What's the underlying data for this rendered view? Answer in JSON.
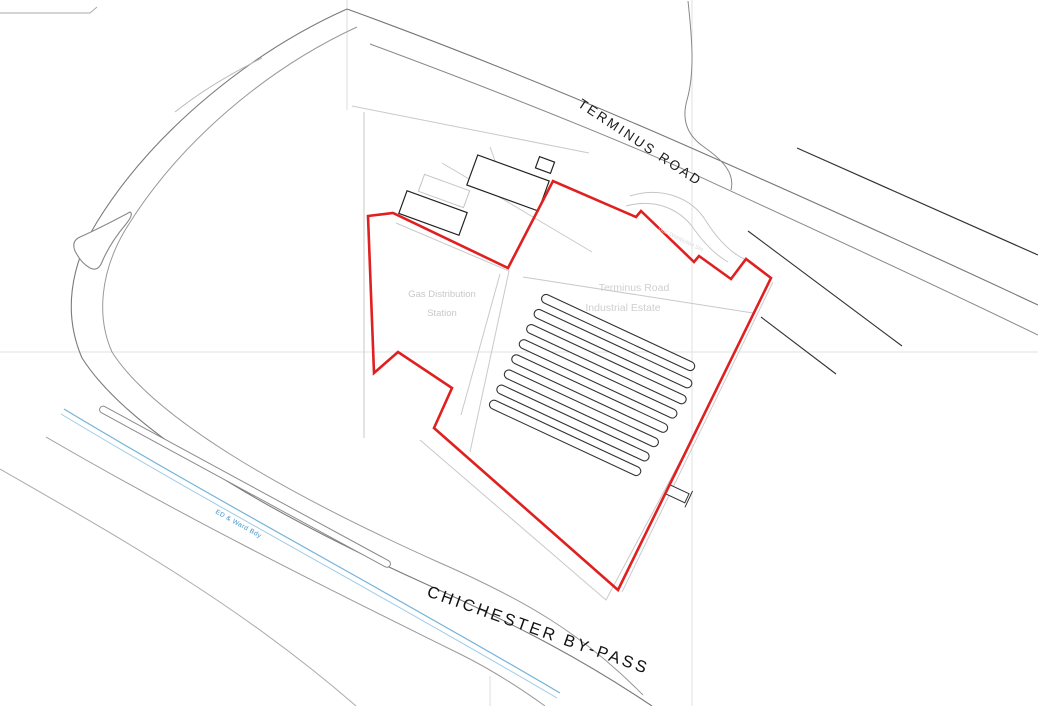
{
  "map": {
    "type": "site-location-plan",
    "colors": {
      "site_boundary": "#e02020",
      "road_lines": "#777777",
      "detail_lines": "#333333",
      "parcel_lines": "#c9c9c9",
      "grid_lines": "#e2e2e2",
      "water_line": "#74b3d8",
      "faint_label": "#cccccc",
      "boundary_label_blue": "#3f8fc5",
      "road_label": "#1a1a1a"
    },
    "labels": {
      "terminus_road": "TERMINUS ROAD",
      "chichester_bypass": "CHICHESTER BY-PASS",
      "gas_station_line1": "Gas Distribution",
      "gas_station_line2": "Station",
      "estate_line1": "Terminus Road",
      "estate_line2": "Industrial Estate",
      "access_note": "Gas Distribution Stn",
      "ward_boundary": "ED & Ward Bdy"
    },
    "features": {
      "yard_rows": 8,
      "outlined_buildings": 3,
      "boundary_style": "red site outline"
    }
  }
}
